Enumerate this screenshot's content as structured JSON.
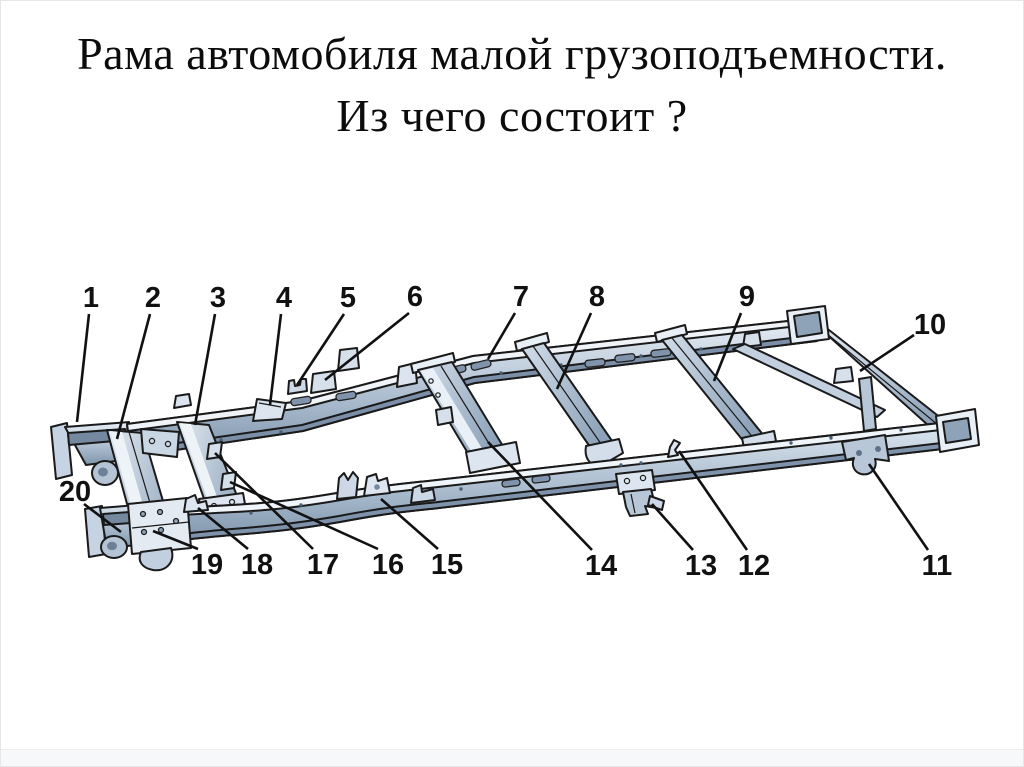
{
  "title": {
    "line1": "Рама автомобиля малой грузоподъемности.",
    "line2": "Из чего состоит ?"
  },
  "diagram": {
    "colors": {
      "outline": "#1a1a1a",
      "leader_line": "#111111",
      "number_text": "#111111",
      "metal_highlight": "#f0f4f9",
      "metal_light": "#dde6f0",
      "metal_mid": "#b8c7d8",
      "metal_dark": "#7e93ab",
      "background": "#ffffff"
    },
    "callouts": [
      {
        "n": "1",
        "x": 90,
        "y": 296,
        "line": [
          88,
          313,
          76,
          421
        ]
      },
      {
        "n": "2",
        "x": 152,
        "y": 296,
        "line": [
          149,
          313,
          116,
          438
        ]
      },
      {
        "n": "3",
        "x": 217,
        "y": 296,
        "line": [
          214,
          313,
          194,
          424
        ]
      },
      {
        "n": "4",
        "x": 283,
        "y": 296,
        "line": [
          280,
          313,
          269,
          404
        ]
      },
      {
        "n": "5",
        "x": 347,
        "y": 296,
        "line": [
          343,
          313,
          296,
          384
        ]
      },
      {
        "n": "6",
        "x": 414,
        "y": 295,
        "line": [
          408,
          312,
          324,
          379
        ]
      },
      {
        "n": "7",
        "x": 520,
        "y": 295,
        "line": [
          514,
          312,
          487,
          358
        ]
      },
      {
        "n": "8",
        "x": 596,
        "y": 295,
        "line": [
          590,
          312,
          556,
          388
        ]
      },
      {
        "n": "9",
        "x": 746,
        "y": 295,
        "line": [
          740,
          312,
          713,
          380
        ]
      },
      {
        "n": "10",
        "x": 929,
        "y": 323,
        "line": [
          913,
          334,
          859,
          370
        ]
      },
      {
        "n": "11",
        "x": 936,
        "y": 564,
        "line": [
          927,
          549,
          868,
          463
        ]
      },
      {
        "n": "12",
        "x": 753,
        "y": 564,
        "line": [
          746,
          549,
          678,
          450
        ]
      },
      {
        "n": "13",
        "x": 700,
        "y": 564,
        "line": [
          692,
          549,
          651,
          503
        ]
      },
      {
        "n": "14",
        "x": 600,
        "y": 564,
        "line": [
          591,
          549,
          487,
          441
        ]
      },
      {
        "n": "15",
        "x": 446,
        "y": 563,
        "line": [
          437,
          548,
          380,
          498
        ]
      },
      {
        "n": "16",
        "x": 387,
        "y": 563,
        "line": [
          377,
          548,
          229,
          481
        ]
      },
      {
        "n": "17",
        "x": 322,
        "y": 563,
        "line": [
          312,
          548,
          214,
          452
        ]
      },
      {
        "n": "18",
        "x": 256,
        "y": 563,
        "line": [
          247,
          548,
          197,
          507
        ]
      },
      {
        "n": "19",
        "x": 206,
        "y": 563,
        "line": [
          197,
          548,
          152,
          530
        ]
      },
      {
        "n": "20",
        "x": 74,
        "y": 490,
        "line": [
          83,
          503,
          120,
          531
        ]
      }
    ]
  }
}
